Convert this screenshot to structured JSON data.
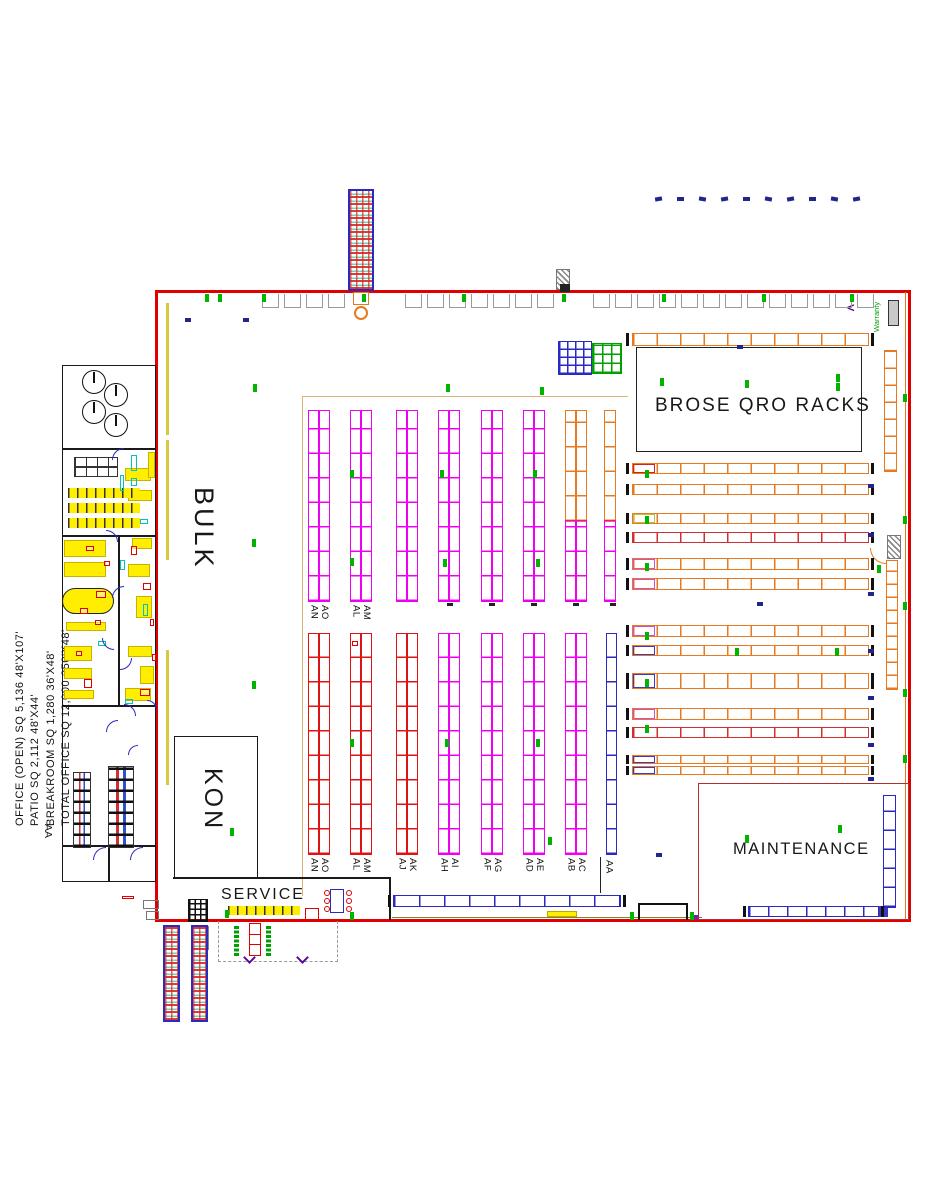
{
  "drawing": {
    "area_table": [
      "TOTAL OFFICE SQ 12,000  250'X48'",
      "BREAKROOM SQ 1,280  36'X48'",
      "PATIO SQ 2,112  48'X44'",
      "OFFICE (OPEN)  SQ 5,136  48'X107'"
    ],
    "side_label": "AA"
  },
  "zones": {
    "bulk": "BULK",
    "kon": "KON",
    "service": "SERVICE",
    "brose_qro_racks": "BROSE QRO RACKS",
    "maintenance": "MAINTENANCE",
    "warranty": "Warranty"
  },
  "rack_aisles": {
    "upper_pairs": [
      [
        "AN",
        "AO"
      ],
      [
        "AL",
        "AM"
      ]
    ],
    "lower_pairs": [
      [
        "AN",
        "AO"
      ],
      [
        "AL",
        "AM"
      ],
      [
        "AJ",
        "AK"
      ],
      [
        "AH",
        "AI"
      ],
      [
        "AF",
        "AG"
      ],
      [
        "AD",
        "AE"
      ],
      [
        "AB",
        "AC"
      ]
    ],
    "end_aisle": "AA"
  },
  "colors": {
    "wall_red": "#e00000",
    "rack_magenta": "#f000f0",
    "rack_red": "#e01212",
    "rack_orange": "#e8791e",
    "rack_crimson": "#d03030",
    "rack_blue": "#2a2ac0",
    "mark_green": "#00b400",
    "mark_blue": "#24248e",
    "highlight_yellow": "#ffee00",
    "accent_cyan": "#00c2c2",
    "maintenance_border": "#b03030",
    "zone_outline_tan": "#ddb37a"
  }
}
